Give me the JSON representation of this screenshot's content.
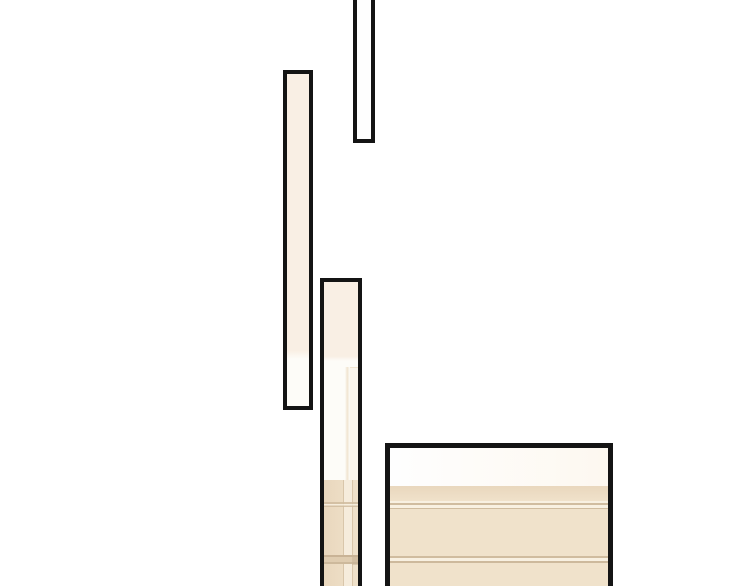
{
  "scene": {
    "description": "Comic page fragment: four black-outlined vertical panels on a white background showing a cream and beige interior wall with trim lines",
    "panel_count": 4
  },
  "panels": [
    {
      "name": "panel-top-narrow",
      "fill": "white_panel"
    },
    {
      "name": "panel-left-tall",
      "fill": "cream over off_white"
    },
    {
      "name": "panel-middle-tall",
      "fill": "cream, off_white, beige with trim"
    },
    {
      "name": "panel-bottom-wide",
      "fill": "white band over beige with trim"
    }
  ],
  "palette": {
    "background": "#ffffff",
    "outline": "#141414",
    "white_panel": "#fefefe",
    "warm_white": "#fdf8f0",
    "cream": "#f9efe4",
    "off_white": "#fdfcf8",
    "tint": "#faf5ec",
    "soft_line": "#f1e5d1",
    "beige": "#f0e2cb",
    "beige_dark": "#e9d7bd",
    "trim_tan": "#d0bc9f",
    "trim_light": "#f8f0e1",
    "band_dark": "#c9b396",
    "band_mid": "#dfccb0",
    "band_edge": "#cdb99c",
    "stripe_light": "#f6ecdc",
    "stripe_edge": "#d9c6aa"
  }
}
